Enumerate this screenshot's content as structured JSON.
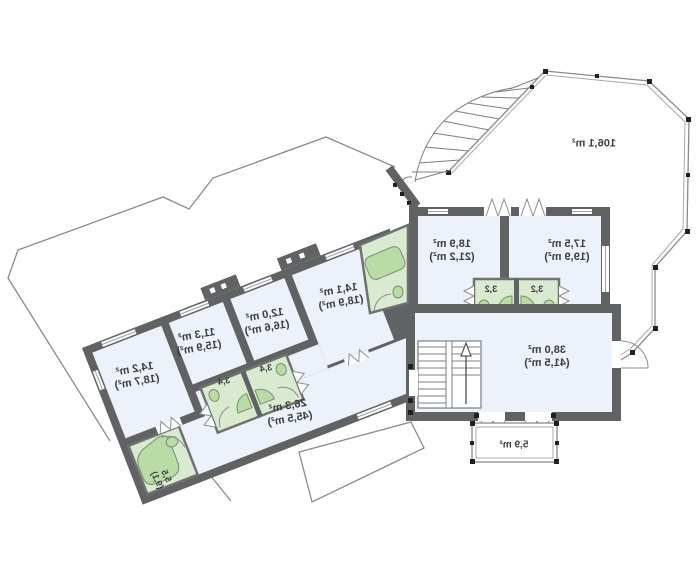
{
  "plan": {
    "type": "floor-plan",
    "units": "m²",
    "colors": {
      "wall": "#606264",
      "room": "#edf1f9",
      "bath": "#d9ead0",
      "fixture": "#b9dba6",
      "outline": "#8a8a8a",
      "text": "#3b3e40"
    },
    "labels": {
      "terrace": {
        "l1": "106,1 m²"
      },
      "room_18_9": {
        "l1": "18,9 m²",
        "l2": "(21,2 m²)"
      },
      "room_17_5": {
        "l1": "17,5 m²",
        "l2": "(19,9 m²)"
      },
      "bath_3_2_left": {
        "l1": "3,2"
      },
      "bath_3_2_right": {
        "l1": "3,2"
      },
      "hall": {
        "l1": "38,0 m²",
        "l2": "(41,5 m²)"
      },
      "balcony": {
        "l1": "5,9 m²"
      },
      "room_14_2": {
        "l1": "14,2 m²",
        "l2": "(18,7 m²)"
      },
      "room_11_3": {
        "l1": "11,3 m²",
        "l2": "(15,9 m²)"
      },
      "room_12_0": {
        "l1": "12,0 m²",
        "l2": "(16,6 m²)"
      },
      "room_14_1": {
        "l1": "14,1 m²",
        "l2": "(18,9 m²)"
      },
      "corridor": {
        "l1": "26,3 m²",
        "l2": "(45,5 m²)"
      },
      "bath_3_4_left": {
        "l1": "3,4"
      },
      "bath_3_4_right": {
        "l1": "3,4"
      },
      "bath_5_5": {
        "l1": "5,5",
        "l2": "(9,1)"
      }
    }
  }
}
